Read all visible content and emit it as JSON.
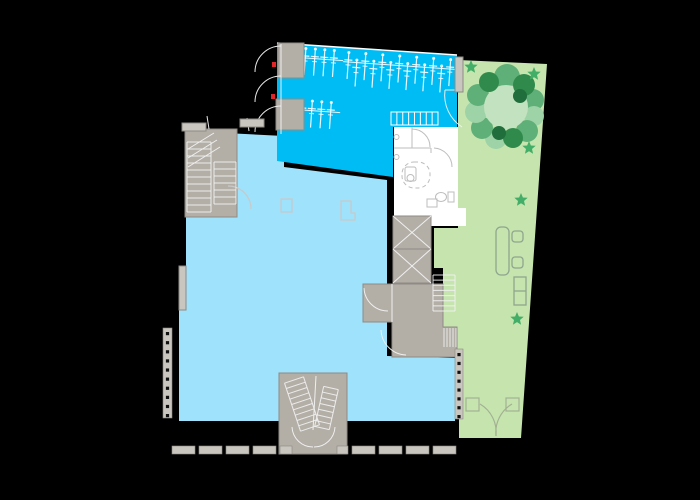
{
  "colors": {
    "background": "#000000",
    "main_hall": "#9fe2fc",
    "bike_storage": "#00bcf5",
    "garden": "#c6e5ae",
    "block_gray": "#b3afa7",
    "room_white": "#ffffff",
    "sidewalk": "#c9c6c0",
    "window_dot": "#111111",
    "door_marker_red": "#e0262b",
    "bike_glyph": "#ffffff",
    "tree_ring": "#9ed3a7",
    "tree_mid": "#5fb078",
    "tree_dark": "#2f8a4b",
    "tree_dark2": "#206e3b",
    "tree_inner": "#c2e2c0",
    "plant_star": "#43ae67",
    "furniture_line": "#8fa58f"
  },
  "plan": {
    "bike_groups": [
      {
        "x": 306,
        "y": 47,
        "count": 4,
        "dx": 9.5,
        "angle": 4,
        "alternate": false
      },
      {
        "x": 349,
        "y": 51,
        "count": 13,
        "dx": 8.5,
        "angle": 4,
        "alternate": true
      },
      {
        "x": 303,
        "y": 99,
        "count": 4,
        "dx": 9.5,
        "angle": 4,
        "alternate": false
      }
    ],
    "lockers": {
      "x": 391,
      "y": 112,
      "cells": 8,
      "w": 47,
      "h": 13
    },
    "plants": [
      [
        471,
        67
      ],
      [
        534,
        74
      ],
      [
        529,
        148
      ],
      [
        521,
        200
      ],
      [
        517,
        319
      ]
    ],
    "tree": {
      "circles": [
        [
          507,
          77,
          13,
          "tree_mid"
        ],
        [
          533,
          100,
          11,
          "tree_mid"
        ],
        [
          534,
          116,
          10,
          "tree_ring"
        ],
        [
          527,
          131,
          11,
          "tree_mid"
        ],
        [
          496,
          138,
          11,
          "tree_ring"
        ],
        [
          482,
          128,
          11,
          "tree_mid"
        ],
        [
          476,
          112,
          11,
          "tree_ring"
        ],
        [
          478,
          95,
          11,
          "tree_mid"
        ],
        [
          506,
          107,
          22,
          "tree_inner"
        ],
        [
          524,
          85,
          11,
          "tree_dark"
        ],
        [
          489,
          82,
          10,
          "tree_dark"
        ],
        [
          513,
          138,
          10,
          "tree_dark"
        ],
        [
          520,
          96,
          7,
          "tree_dark2"
        ],
        [
          499,
          133,
          7,
          "tree_dark2"
        ]
      ]
    },
    "sidewalk_dashes": {
      "y": 446,
      "h": 8,
      "items": [
        [
          172,
          23
        ],
        [
          199,
          23
        ],
        [
          226,
          23
        ],
        [
          253,
          23
        ],
        [
          280,
          12
        ],
        [
          337,
          11
        ],
        [
          352,
          23
        ],
        [
          379,
          23
        ],
        [
          406,
          23
        ],
        [
          433,
          23
        ]
      ]
    },
    "dot_strips": [
      {
        "x": 163,
        "y": 328,
        "w": 9,
        "h": 90,
        "dots": 10
      },
      {
        "x": 455,
        "y": 349,
        "w": 8,
        "h": 70,
        "dots": 8
      }
    ],
    "stair_flights": [
      {
        "x1": 199,
        "y1": 142,
        "x2": 199,
        "y2": 212,
        "w": 24,
        "n": 10
      },
      {
        "x1": 225,
        "y1": 162,
        "x2": 225,
        "y2": 204,
        "w": 22,
        "n": 6
      },
      {
        "x1": 444,
        "y1": 275,
        "x2": 444,
        "y2": 311,
        "w": 22,
        "n": 7
      },
      {
        "x1": 294,
        "y1": 380,
        "x2": 310,
        "y2": 428,
        "w": 20,
        "n": 9
      },
      {
        "x1": 331,
        "y1": 388,
        "x2": 322,
        "y2": 428,
        "w": 15,
        "n": 7
      }
    ],
    "core_hatch": {
      "x": 444,
      "y": 328,
      "h": 19,
      "lines": 5,
      "step": 3
    }
  }
}
